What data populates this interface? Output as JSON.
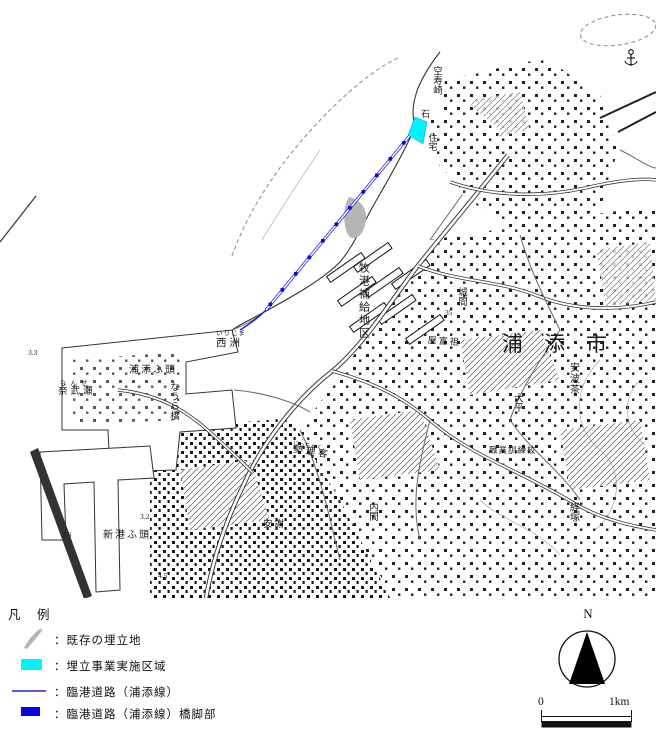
{
  "colors": {
    "reclamation_area": "#00f2ff",
    "port_road": "#2323c8",
    "pier": "#0a0adc",
    "existing_reclaimed": "#b5b5b5"
  },
  "map": {
    "labels": {
      "kujuzaki": "空寿崎",
      "ishi": "石",
      "jutaku": "住宅",
      "makiminato_depot": "牧港補給地区",
      "urasoe_city": "浦添市",
      "urasoe_wharf": "浦添ふ頭",
      "naura_bridge": "なうら橋",
      "nanse_furigana": "なんせ",
      "nabuse": "奈武瀬",
      "irijima_furigana": "いりじま",
      "nishisu": "西洲",
      "shinko_wharf": "新港ふ頭",
      "jicchaku_furigana": "じっちゃく",
      "jicchaku": "勢理客",
      "yafuso": "屋富祖",
      "gusukuma": "城間",
      "vocational_school": "職業訓練校",
      "ahacha": "安波茶",
      "ohira": "大平",
      "kyozuka": "経塚",
      "uchima": "内間",
      "aja": "安謝"
    },
    "spot_elevations": {
      "e1": "3.3",
      "e2": "2.6",
      "e3": "3.2",
      "e4": "4.5",
      "e5": "35"
    }
  },
  "legend": {
    "title": "凡　例",
    "items": [
      {
        "label": "：既存の埋立地"
      },
      {
        "label": "：埋立事業実施区域"
      },
      {
        "label": "：臨港道路（浦添線）"
      },
      {
        "label": "：臨港道路（浦添線）橋脚部"
      }
    ]
  },
  "compass": {
    "north_label": "N"
  },
  "scale": {
    "zero_label": "0",
    "end_label": "1km"
  }
}
